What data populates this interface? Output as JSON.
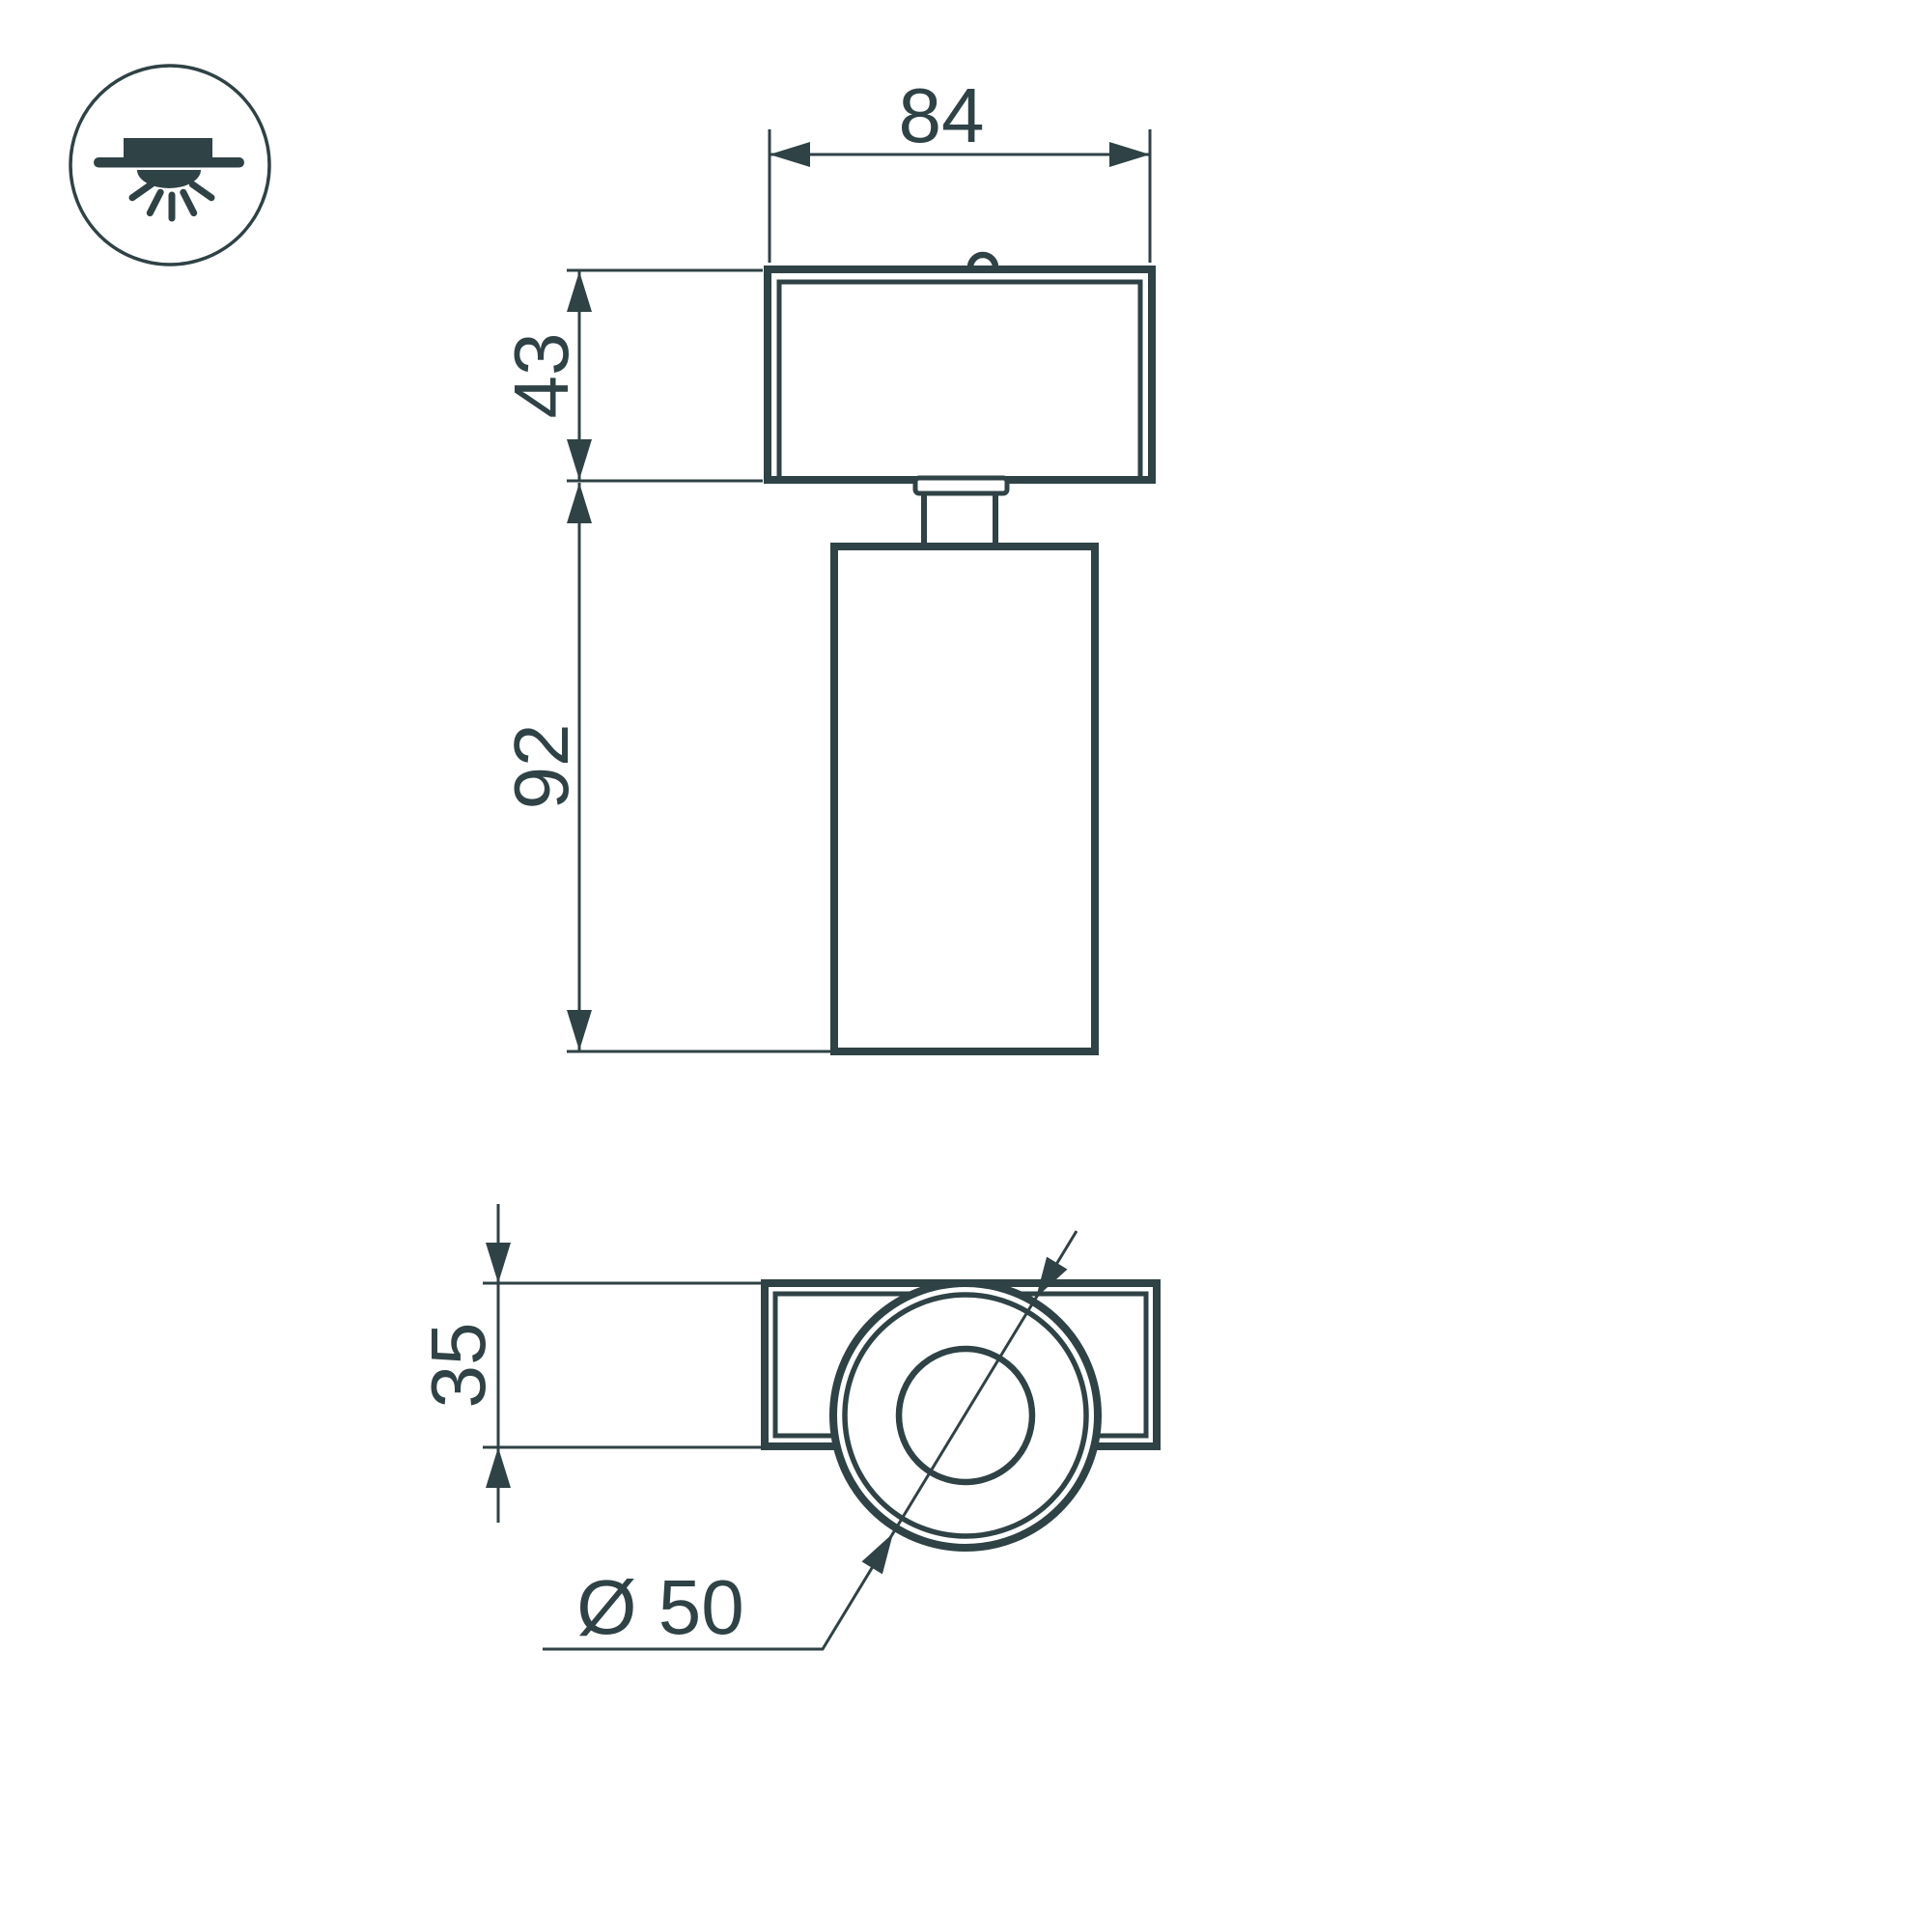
{
  "page": {
    "background_color": "#ffffff",
    "line_color": "#2f4245"
  },
  "badge": {
    "icon": "ceiling-surface-mount-light-icon"
  },
  "front_view": {
    "dim_width": {
      "value": "84"
    },
    "dim_upper_height": {
      "value": "43"
    },
    "dim_body_height": {
      "value": "92"
    }
  },
  "bottom_view": {
    "dim_depth": {
      "value": "35"
    },
    "dim_diameter": {
      "value": "Ø 50"
    }
  }
}
